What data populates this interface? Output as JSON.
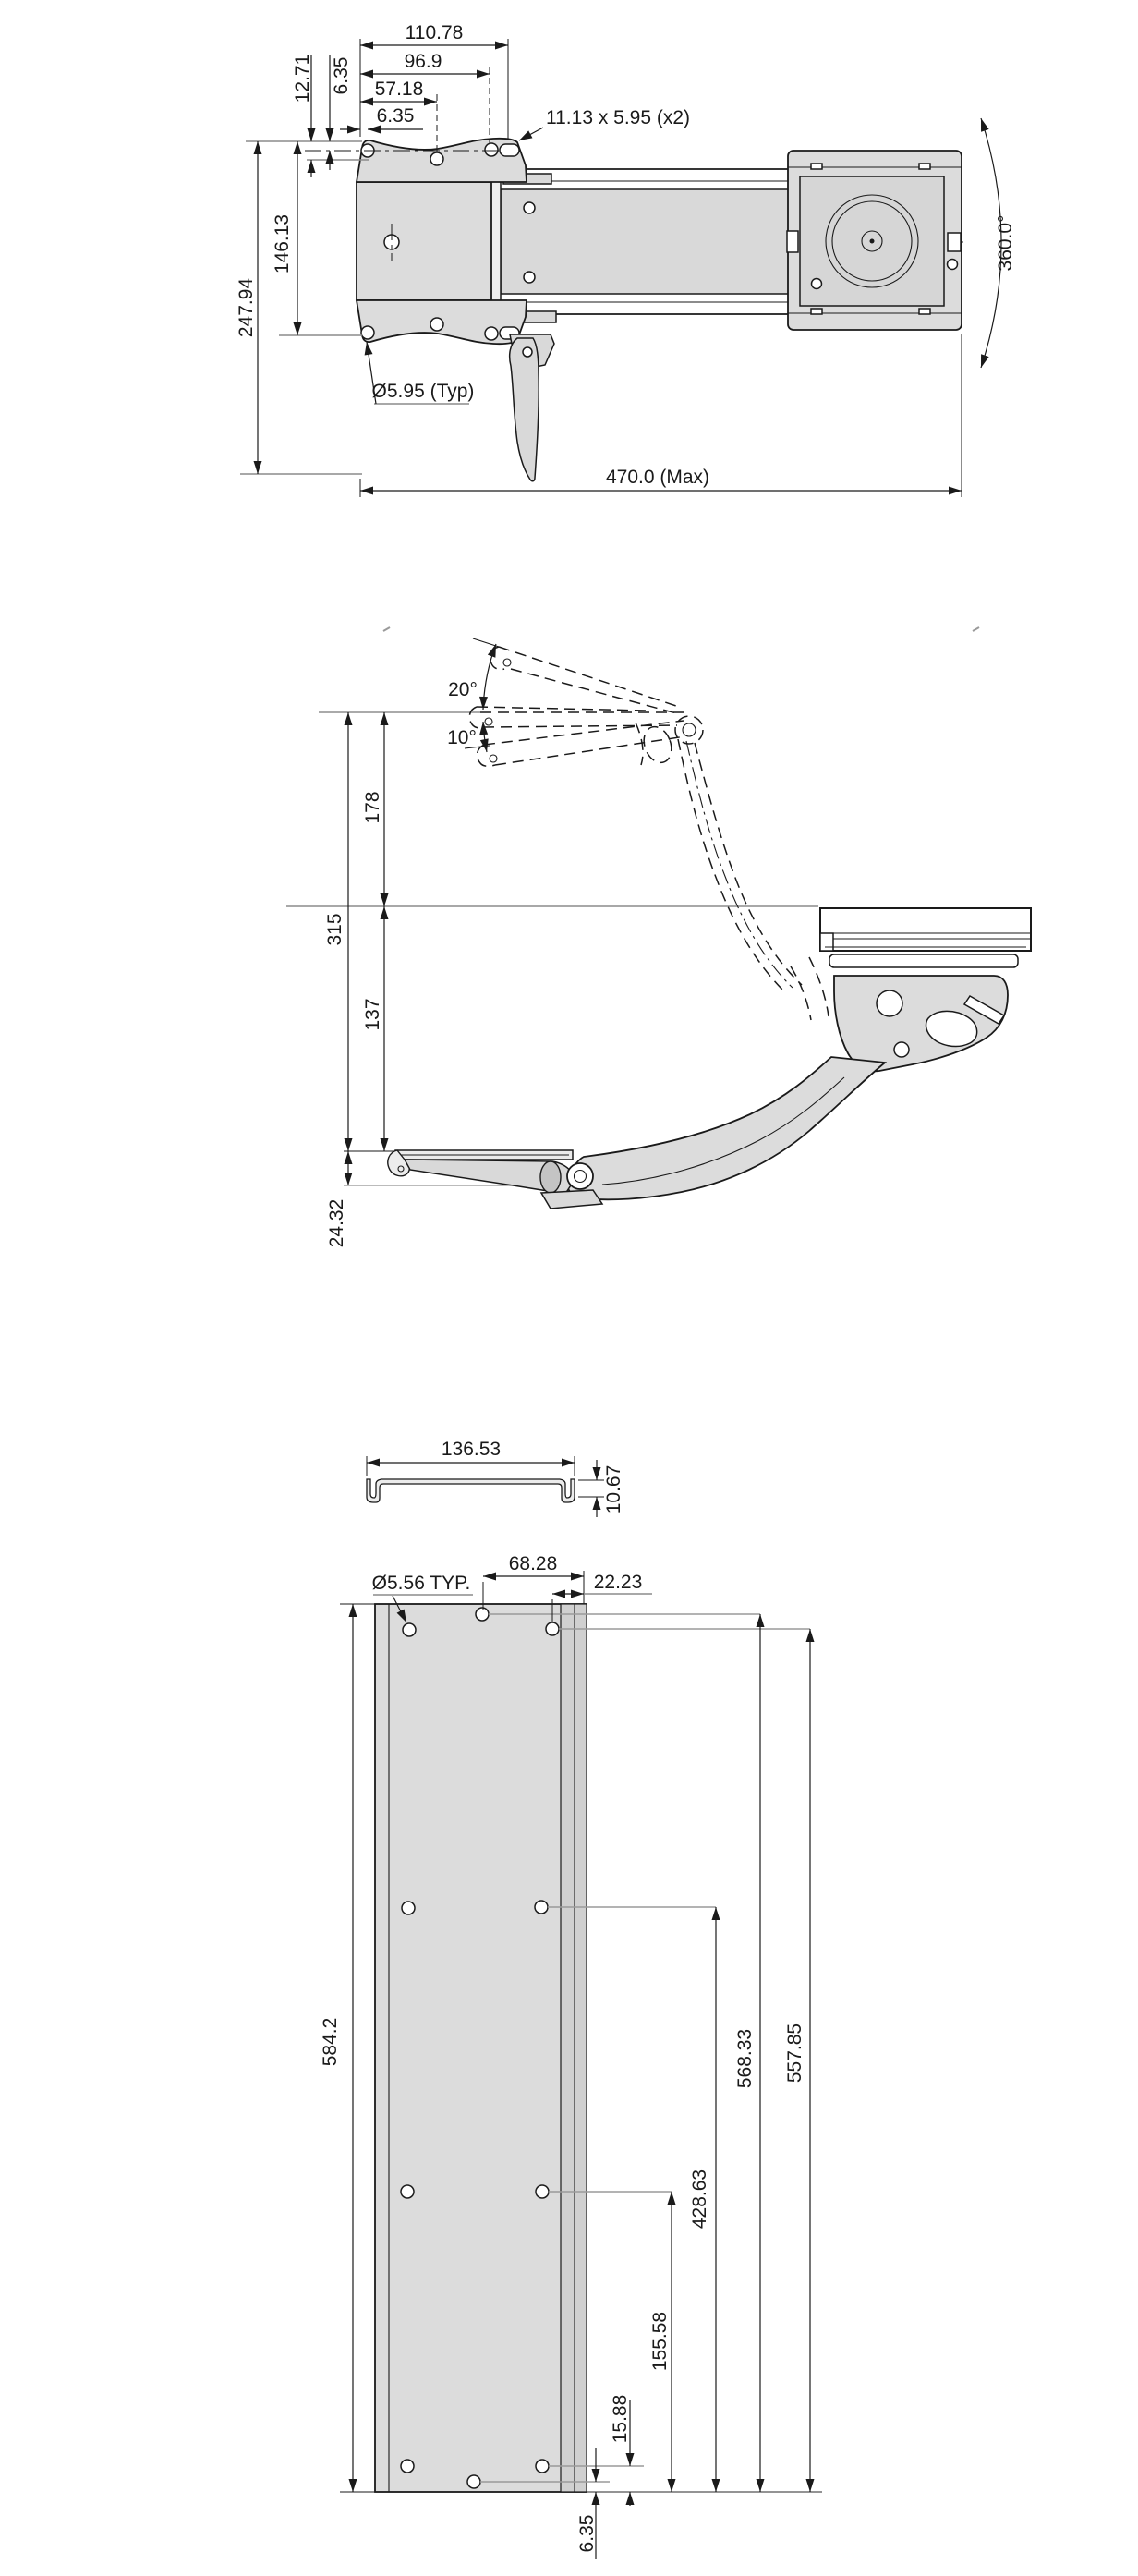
{
  "drawing": {
    "background": "#ffffff",
    "line_color": "#1a1a1a",
    "part_fill_color": "#dcdcdc",
    "reference_line_color": "#8c8c8c",
    "top_view": {
      "dim_width_outer": "110.78",
      "dim_width_mid": "96.9",
      "dim_width_inner": "57.18",
      "dim_edge_offset": "6.35",
      "dim_top_offset_outer": "12.71",
      "dim_top_offset_inner": "6.35",
      "dim_height_inner": "146.13",
      "dim_height_outer": "247.94",
      "note_slot": "11.13 x 5.95 (x2)",
      "note_hole": "Ø5.95 (Typ)",
      "dim_length": "470.0 (Max)",
      "dim_swivel": "360.0°"
    },
    "side_view": {
      "dim_tilt_up": "20°",
      "dim_tilt_down": "10°",
      "dim_above": "178",
      "dim_total": "315",
      "dim_below": "137",
      "dim_drop": "24.32"
    },
    "bottom_view": {
      "dim_channel_width": "136.53",
      "dim_channel_height": "10.67",
      "note_hole": "Ø5.56 TYP.",
      "dim_hole_inset": "68.28",
      "dim_edge_inset": "22.23",
      "dim_plate_length": "584.2",
      "dim_row_a": "568.33",
      "dim_row_b": "557.85",
      "dim_row_c": "428.63",
      "dim_row_d": "155.58",
      "dim_row_e": "15.88",
      "dim_row_f": "6.35"
    }
  }
}
